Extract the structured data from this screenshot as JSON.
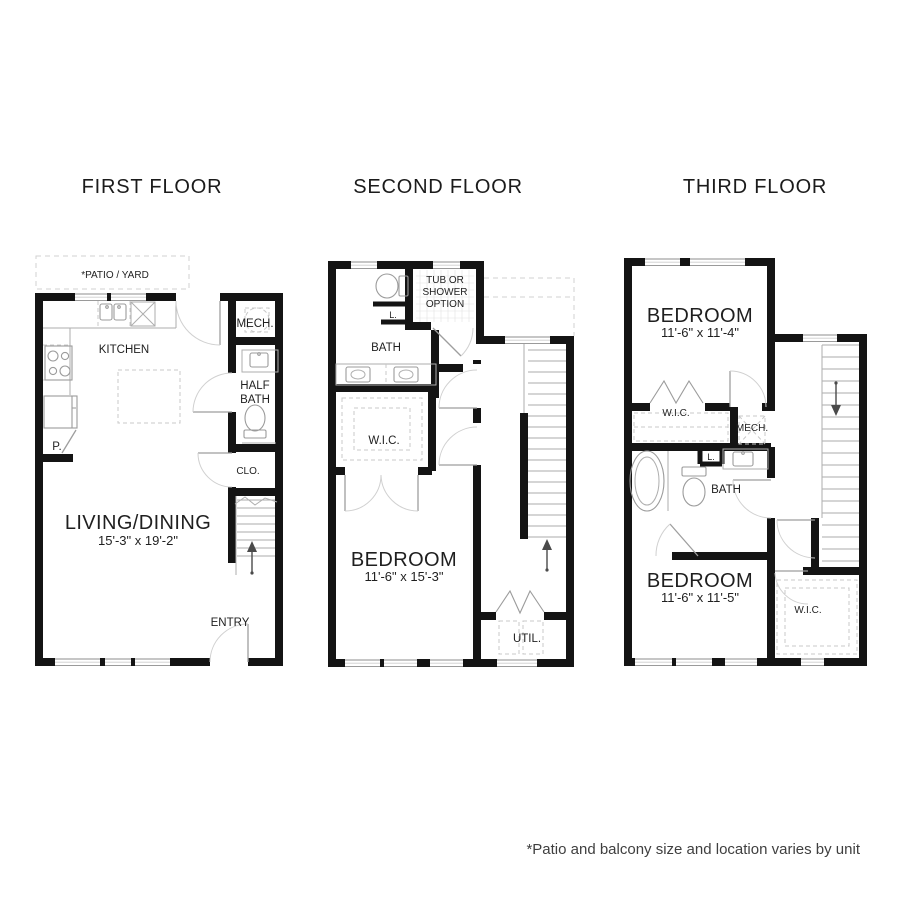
{
  "page": {
    "background": "#ffffff",
    "wall_color": "#141414",
    "fixture_line_color": "#aeaeae",
    "footnote": "*Patio and balcony size and location varies by unit"
  },
  "floors": [
    {
      "id": "first",
      "title": "FIRST FLOOR",
      "labels": {
        "patio": "*PATIO / YARD",
        "kitchen": "KITCHEN",
        "mech": "MECH.",
        "half_bath_line1": "HALF",
        "half_bath_line2": "BATH",
        "closet": "CLO.",
        "pantry": "P.",
        "room": "LIVING/DINING",
        "room_dims": "15'-3\" x 19'-2\"",
        "entry": "ENTRY"
      }
    },
    {
      "id": "second",
      "title": "SECOND FLOOR",
      "labels": {
        "tub_line1": "TUB OR",
        "tub_line2": "SHOWER",
        "tub_line3": "OPTION",
        "bath": "BATH",
        "linen": "L.",
        "wic": "W.I.C.",
        "room": "BEDROOM",
        "room_dims": "11'-6\" x 15'-3\"",
        "util": "UTIL."
      }
    },
    {
      "id": "third",
      "title": "THIRD FLOOR",
      "labels": {
        "bedroom1": "BEDROOM",
        "bedroom1_dims": "11'-6\" x 11'-4\"",
        "wic1": "W.I.C.",
        "mech": "MECH.",
        "linen": "L.",
        "bath": "BATH",
        "bedroom2": "BEDROOM",
        "bedroom2_dims": "11'-6\" x 11'-5\"",
        "wic2": "W.I.C."
      }
    }
  ]
}
